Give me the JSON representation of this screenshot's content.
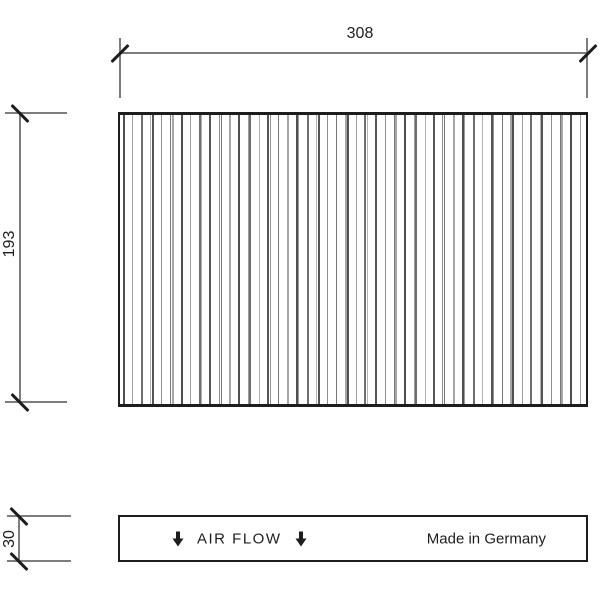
{
  "drawing": {
    "dimensions": {
      "width": {
        "label": "308"
      },
      "height": {
        "label": "193"
      },
      "depth": {
        "label": "30"
      }
    },
    "label_box": {
      "air_flow": "AIR FLOW",
      "made_in": "Made in Germany",
      "arrow_icon": "down-arrow"
    },
    "pleats": {
      "count": 66,
      "shades": [
        "#4f4f4f",
        "#9c9c9c",
        "#6e6e6e",
        "#b2b2b2",
        "#555555",
        "#8f8f8f",
        "#777777",
        "#a6a6a6"
      ],
      "widths": [
        2,
        1,
        2,
        1,
        2,
        1,
        1,
        2
      ]
    },
    "colors": {
      "line_gray": "#7d7d7d",
      "ink_black": "#1d1d1d",
      "background": "#ffffff"
    }
  }
}
